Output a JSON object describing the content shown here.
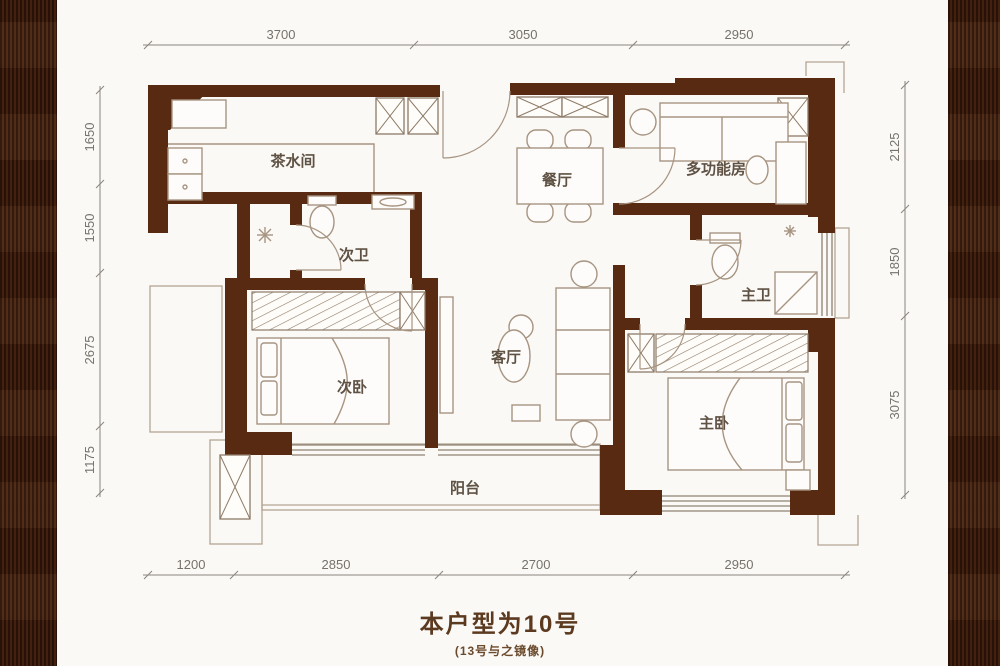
{
  "title": {
    "main": "本户型为10号",
    "sub": "(13号与之镜像)"
  },
  "rooms": [
    {
      "id": "tea-room",
      "label": "茶水间"
    },
    {
      "id": "dining",
      "label": "餐厅"
    },
    {
      "id": "multi-function",
      "label": "多功能房"
    },
    {
      "id": "bath-second",
      "label": "次卫"
    },
    {
      "id": "bath-master",
      "label": "主卫"
    },
    {
      "id": "bedroom-second",
      "label": "次卧"
    },
    {
      "id": "living",
      "label": "客厅"
    },
    {
      "id": "bedroom-master",
      "label": "主卧"
    },
    {
      "id": "balcony",
      "label": "阳台"
    }
  ],
  "dims": {
    "top": [
      "3700",
      "3050",
      "2950"
    ],
    "bottom": [
      "1200",
      "2850",
      "2700",
      "2950"
    ],
    "left": [
      "1650",
      "1550",
      "2675",
      "1175"
    ],
    "right": [
      "2125",
      "1850",
      "3075"
    ]
  },
  "colors": {
    "wall": "#572a11",
    "side_panel": "#3f1f0d",
    "furniture_line": "#a79481",
    "dim_text": "#76726b",
    "room_text": "#5f5244",
    "title_text": "#5c3a20"
  }
}
